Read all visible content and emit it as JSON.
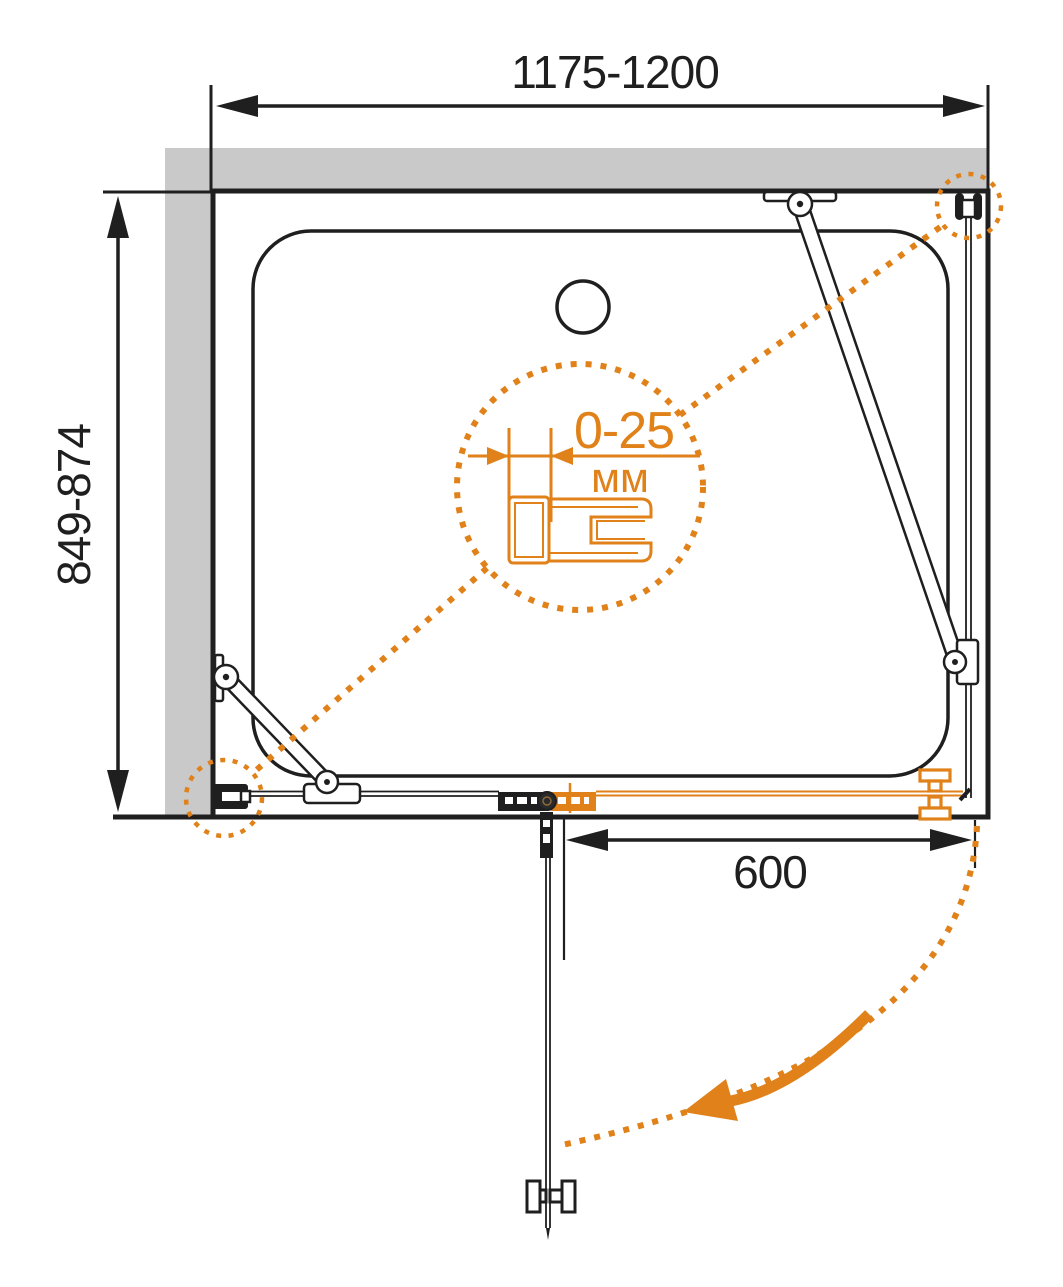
{
  "title": "shower-enclosure-installation-plan",
  "dimensions": {
    "width_range": "1175-1200",
    "depth_range": "849-874",
    "door_width": "600",
    "adjustment_range": "0-25",
    "adjustment_unit": "мм"
  },
  "colors": {
    "accent_orange": "#E08119",
    "wall_gray": "#C9C9C9",
    "line_black": "#1F1F1F"
  },
  "legend": {
    "detail_callout": "telescopic-wall-profile-adjustment",
    "swing_path": "door-swing-arc",
    "tray": "shower-tray",
    "drain": "drain-hole"
  }
}
